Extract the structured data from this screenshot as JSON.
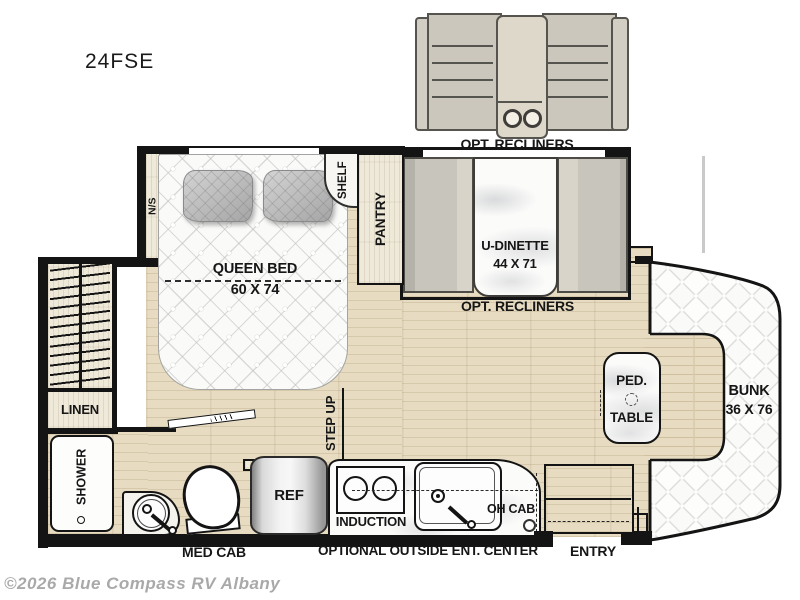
{
  "header": {
    "model": "24FSE"
  },
  "footer": {
    "watermark": "©2026 Blue Compass RV Albany"
  },
  "exterior": {
    "opt_recliners_label": "OPT. RECLINERS"
  },
  "bedroom": {
    "queen_bed": "QUEEN BED",
    "queen_bed_size": "60 X 74",
    "nightstand": "N/S",
    "shelf": "SHELF",
    "pantry": "PANTRY"
  },
  "dinette": {
    "label": "U-DINETTE",
    "size": "44 X 71",
    "opt_recliners_label": "OPT. RECLINERS"
  },
  "bath": {
    "linen": "LINEN",
    "shower": "SHOWER",
    "med_cab": "MED CAB"
  },
  "kitchen": {
    "ref": "REF",
    "induction": "INDUCTION",
    "oh_cab": "OH CAB",
    "outside_center": "OPTIONAL OUTSIDE ENT. CENTER",
    "step_up": "STEP UP"
  },
  "front": {
    "ped_table_line1": "PED.",
    "ped_table_line2": "TABLE",
    "bunk": "BUNK",
    "bunk_size": "36 X 76",
    "entry": "ENTRY"
  },
  "colors": {
    "wall": "#141414",
    "floor_wood": "#e7dcc1",
    "cabinet_wood": "#efe9da",
    "furniture_gray": "#c6c3ba",
    "mattress": "#fafaf9",
    "watermark": "#a9a9a9"
  }
}
